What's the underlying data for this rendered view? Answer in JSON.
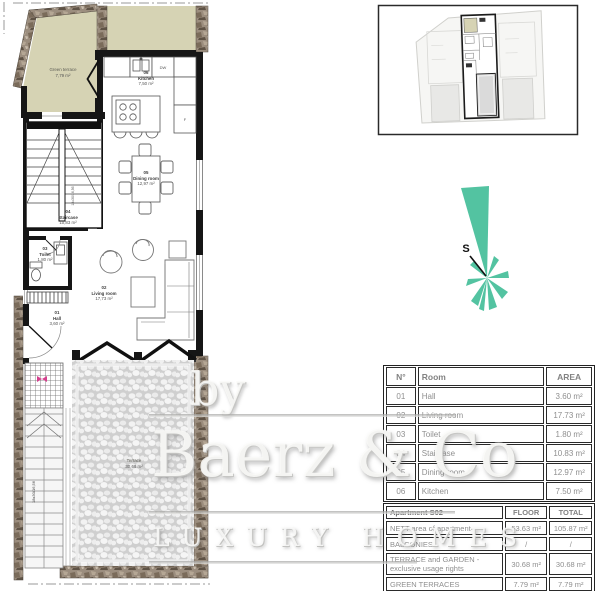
{
  "plan": {
    "green_terrace": {
      "name": "Green terrace",
      "area": "7,79 m²"
    },
    "terrace": {
      "name": "Terrace",
      "area": "30,68 m²"
    },
    "rooms": [
      {
        "num": "01",
        "name": "Hall",
        "area": "3,60 m²"
      },
      {
        "num": "02",
        "name": "Living room",
        "area": "17,73 m²"
      },
      {
        "num": "03",
        "name": "Toilet",
        "area": "1,80 m²"
      },
      {
        "num": "04",
        "name": "Staircase",
        "area": "10,83 m²"
      },
      {
        "num": "05",
        "name": "Dining room",
        "area": "12,97 m²"
      },
      {
        "num": "06",
        "name": "Kitchen",
        "area": "7,50 m²"
      }
    ],
    "appliances": {
      "dishwasher": "DW",
      "fridge": "F"
    },
    "stair_dimension": "18x30/16,56"
  },
  "compass": {
    "label": "S"
  },
  "watermark": {
    "prefix": "by",
    "brand": "Baerz & Co",
    "tagline": "LUXURY HOMES"
  },
  "room_table": {
    "headers": [
      "N°",
      "Room",
      "AREA"
    ],
    "rows": [
      [
        "01",
        "Hall",
        "3.60 m²"
      ],
      [
        "02",
        "Living room",
        "17.73 m²"
      ],
      [
        "03",
        "Toilet",
        "1.80 m²"
      ],
      [
        "04",
        "Staircase",
        "10.83 m²"
      ],
      [
        "05",
        "Dining room",
        "12.97 m²"
      ],
      [
        "06",
        "Kitchen",
        "7.50 m²"
      ]
    ]
  },
  "summary_table": {
    "title": "Apartment S02",
    "headers": [
      "FLOOR",
      "TOTAL"
    ],
    "rows": [
      [
        "NETT area of apartment",
        "53.63 m²",
        "105.87 m²"
      ],
      [
        "BALCONIES",
        "/",
        "/"
      ],
      [
        "TERRACE and GARDEN - exclusive usage rights",
        "30.68 m²",
        "30.68 m²"
      ],
      [
        "GREEN TERRACES",
        "7.79 m²",
        "7.79 m²"
      ],
      [
        "GARAGE - basement",
        "/",
        "53.80 m²"
      ]
    ]
  },
  "colors": {
    "compass_teal": "#53c3a1",
    "green_area": "#d6d3b4",
    "entrance_marker_pink": "#d4418e"
  }
}
